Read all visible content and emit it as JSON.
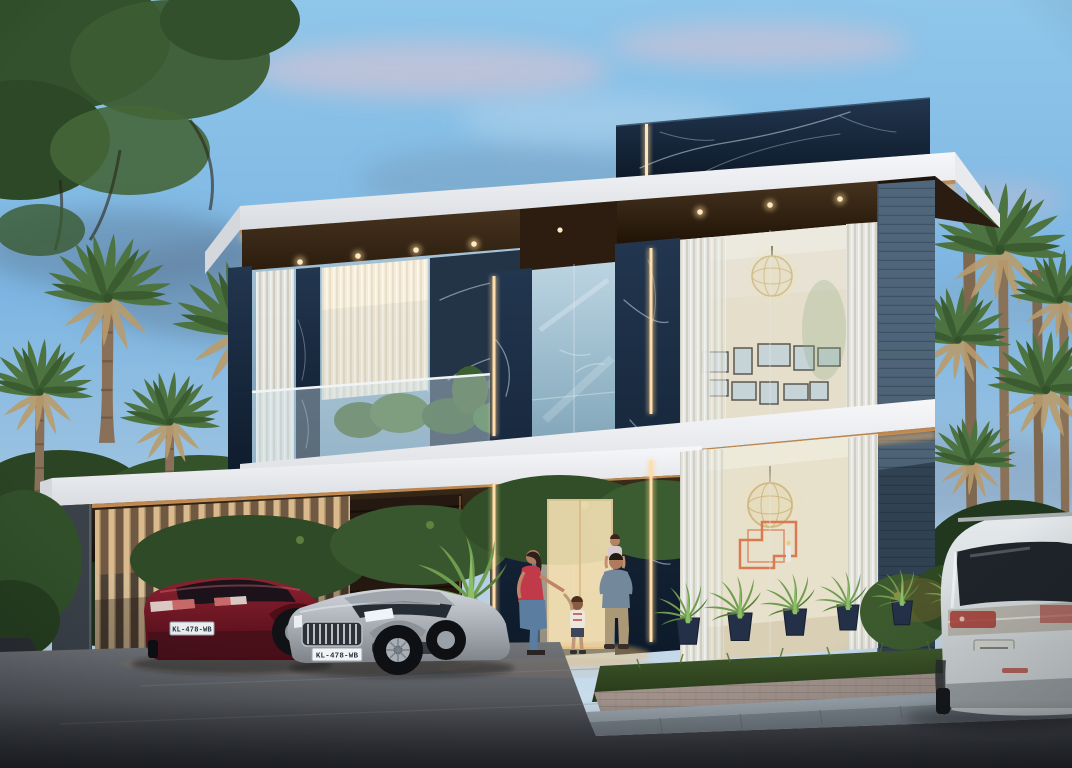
{
  "scene": {
    "type": "3d architectural rendering",
    "time_of_day": "dusk",
    "subject": "modern two-storey luxury villa with lit interiors",
    "setting": "tropical street with palm trees, carport, family at entrance"
  },
  "building": {
    "storeys": 2,
    "materials": [
      "black marble with white veining",
      "white fascia bands",
      "floor-to-ceiling glass",
      "dark timber soffits",
      "blue-grey ledgestone pier",
      "vertical timber louvres"
    ],
    "lighting": "warm LED strip edges and recessed downlights"
  },
  "vehicles": {
    "red_car": {
      "type": "hatchback",
      "color": "#5c1220",
      "plate": "KL-478-WB"
    },
    "silver_car": {
      "type": "sedan",
      "color": "#b7bcc2",
      "plate": "KL-478-WB"
    },
    "white_suv": {
      "type": "suv",
      "color": "#dde2e4"
    }
  },
  "people": {
    "woman": "red top and blue jeans, walking with child",
    "child": "light shirt, holding woman's hand",
    "man": "grey-blue shirt carrying toddler on shoulders in doorway"
  },
  "palette": {
    "sky_top": "#8fc6ea",
    "sky_horizon": "#c3d9ea",
    "cloud_pink": "#ecc4ce",
    "cloud_grey": "#64809c",
    "marble": "#16293e",
    "marble_vein": "#cfe4ee",
    "fascia_white": "#f2f3f5",
    "bronze_trim": "#b9854f",
    "glow_warm": "#f2b368",
    "timber": "#35271c",
    "louvre_lit": "#d6bd95",
    "stone_blue": "#5f7689",
    "foliage": "#3c5c33",
    "grass": "#3a5226",
    "road": "#55585c",
    "art_orange": "#e2703c"
  }
}
